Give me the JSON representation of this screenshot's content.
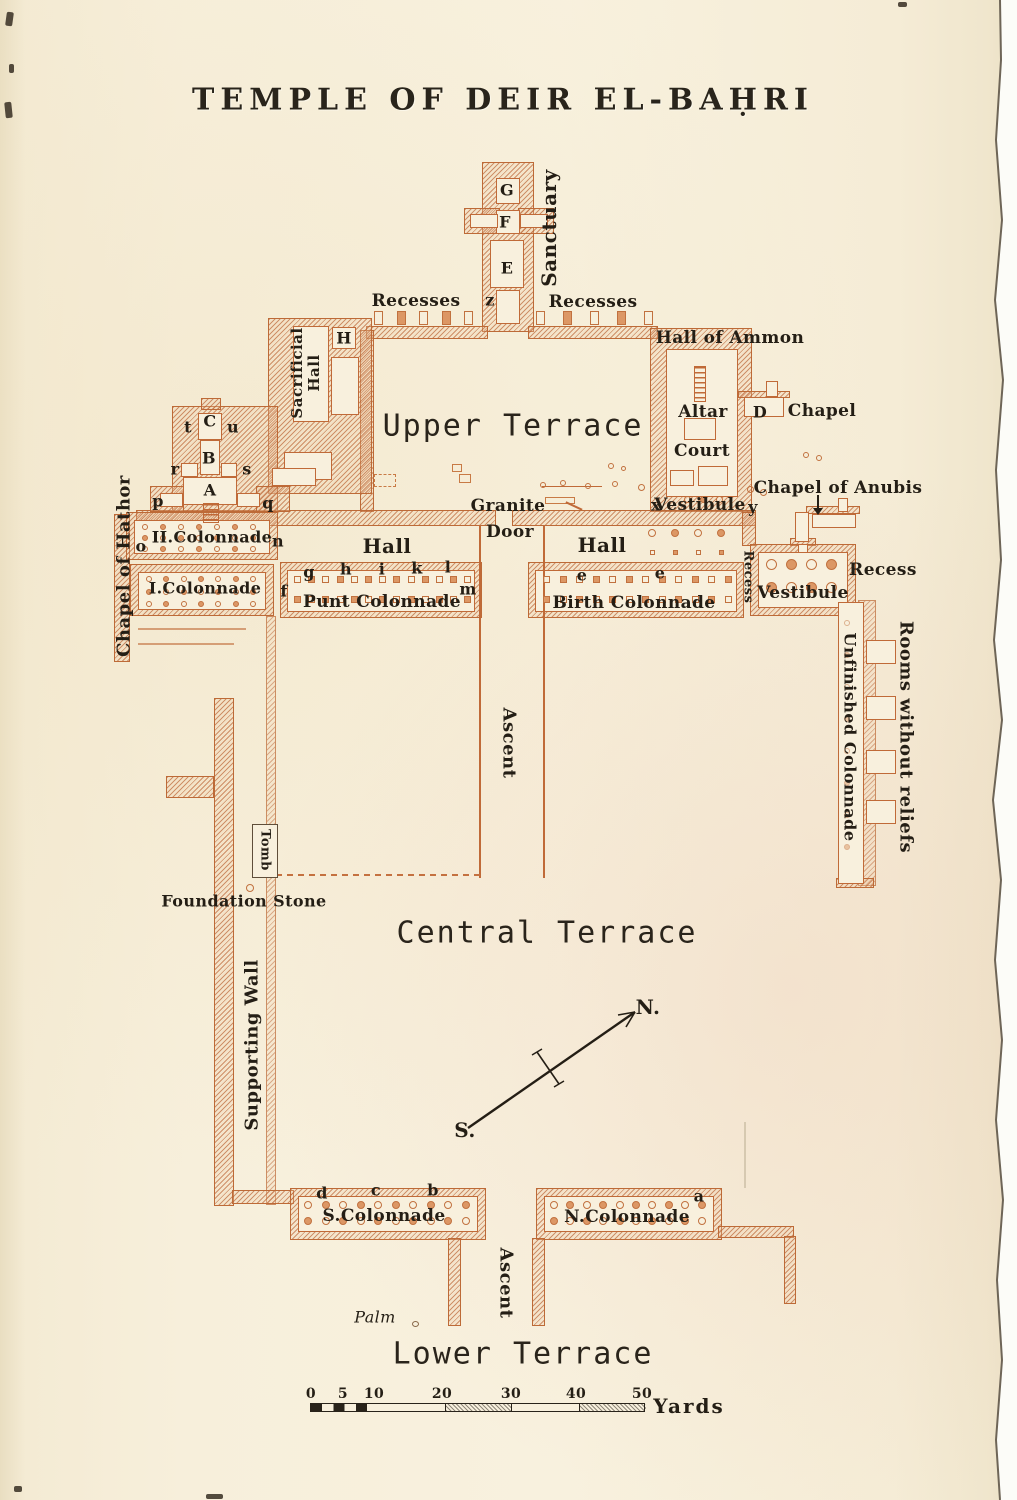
{
  "title": "TEMPLE OF DEIR EL-BAḤRI",
  "upper": {
    "sanctuary": "Sanctuary",
    "g": "G",
    "f": "F",
    "e": "E",
    "recesses_left": "Recesses",
    "z": "z",
    "recesses_right": "Recesses",
    "sacrificial_hall": "Sacrificial Hall",
    "h": "H",
    "hall_of_ammon": "Hall of Ammon",
    "terrace": "Upper Terrace",
    "altar": "Altar",
    "court": "Court",
    "d": "D",
    "chapel": "Chapel",
    "granite": "Granite",
    "door": "Door",
    "x": "x",
    "vestibule": "Vestibule",
    "y": "y",
    "chapel_of_anubis": "Chapel of Anubis"
  },
  "hathor": {
    "label": "Chapel of Hathor",
    "colonnade2": "II.Colonnade",
    "colonnade1": "I.Colonnade",
    "t": "t",
    "C": "C",
    "u": "u",
    "B": "B",
    "r": "r",
    "s": "s",
    "A": "A",
    "p": "p",
    "q": "q",
    "o": "o",
    "n": "n"
  },
  "middle": {
    "hall_left": "Hall",
    "hall_right": "Hall",
    "punt": "Punt Colonnade",
    "birth": "Birth Colonnade",
    "letters_punt": [
      "f",
      "g",
      "h",
      "i",
      "k",
      "l",
      "m"
    ],
    "letters_birth": [
      "e",
      "e"
    ],
    "recess_w": "Recess",
    "vestibule": "Vestibule",
    "recess_e": "Recess",
    "unfinished": "Unfinished Colonnade",
    "rooms": "Rooms without reliefs",
    "ascent": "Ascent"
  },
  "central": {
    "label": "Central Terrace",
    "tomb": "Tomb",
    "foundation_stone": "Foundation Stone",
    "supporting_wall": "Supporting Wall",
    "north": "N.",
    "south": "S."
  },
  "lower": {
    "s_colonnade": "S.Colonnade",
    "n_colonnade": "N.Colonnade",
    "letters_s": [
      "d",
      "c",
      "b"
    ],
    "letter_n": "a",
    "ascent": "Ascent",
    "palm": "Palm",
    "label": "Lower Terrace"
  },
  "scale": {
    "ticks": [
      "0",
      "5",
      "10",
      "20",
      "30",
      "40",
      "50"
    ],
    "unit": "Yards"
  }
}
